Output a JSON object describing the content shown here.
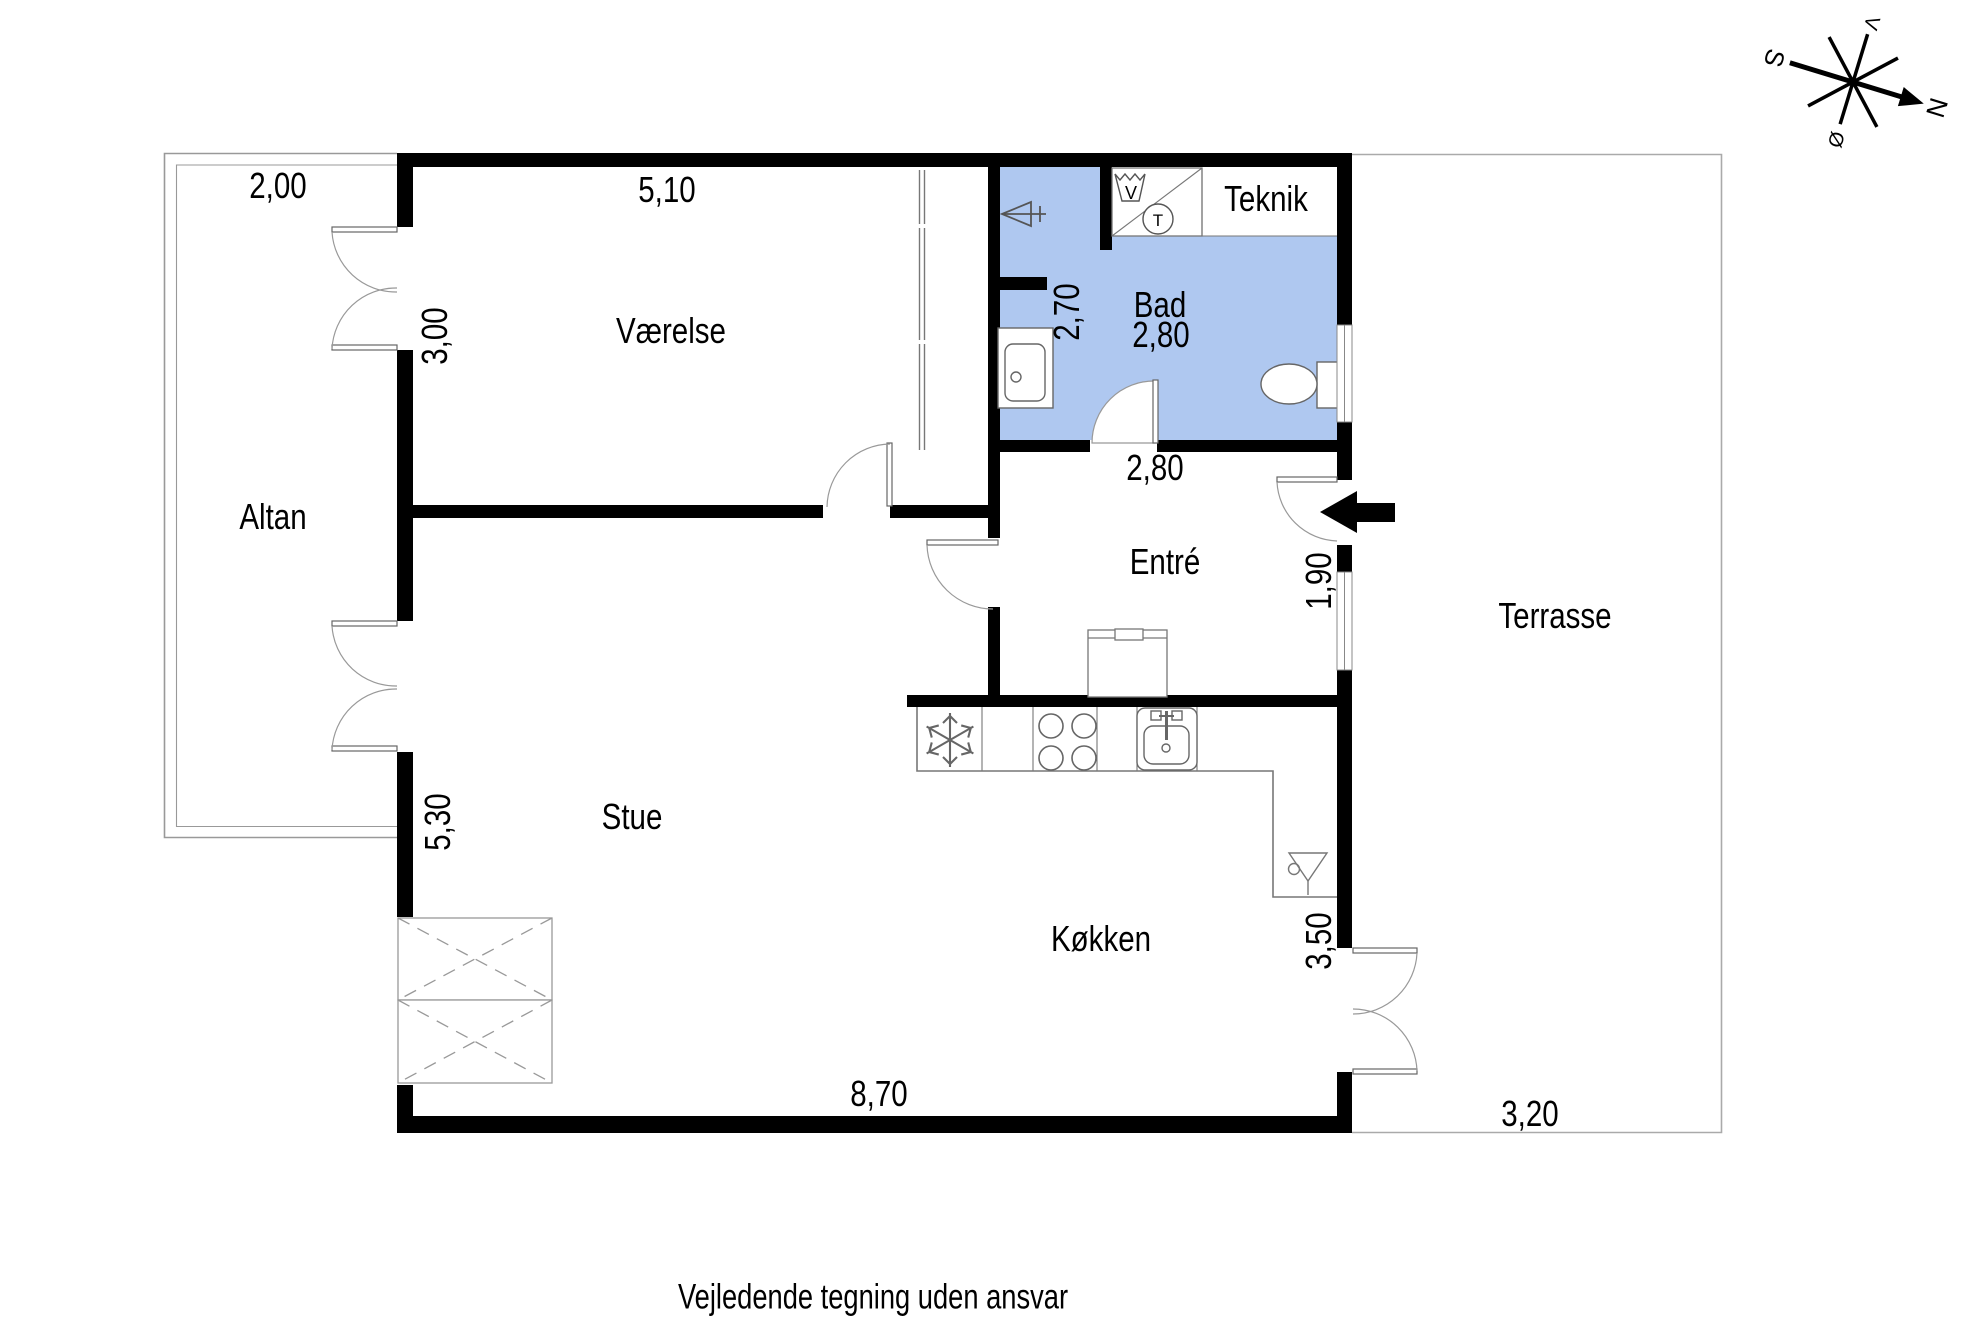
{
  "caption": "Vejledende tegning uden ansvar",
  "rooms": {
    "altan": "Altan",
    "vaerelse": "Værelse",
    "bad": "Bad",
    "teknik": "Teknik",
    "entre": "Entré",
    "terrasse": "Terrasse",
    "stue": "Stue",
    "koekken": "Køkken"
  },
  "dimensions": {
    "altan_width": "2,00",
    "vaerelse_width": "5,10",
    "vaerelse_depth": "3,00",
    "bad_depth": "2,70",
    "bad_width": "2,80",
    "entre_width": "2,80",
    "entre_window": "1,90",
    "stue_depth": "5,30",
    "koekken_depth": "3,50",
    "bottom_width": "8,70",
    "terrasse_width": "3,20"
  },
  "compass": {
    "north": "N",
    "south": "S",
    "west": "V",
    "east": "Ø"
  },
  "fixtures": {
    "washing_machine": "V",
    "tumble_dryer": "T"
  },
  "colors": {
    "bathroom_fill": "#afc8f0",
    "wall": "#000000"
  }
}
